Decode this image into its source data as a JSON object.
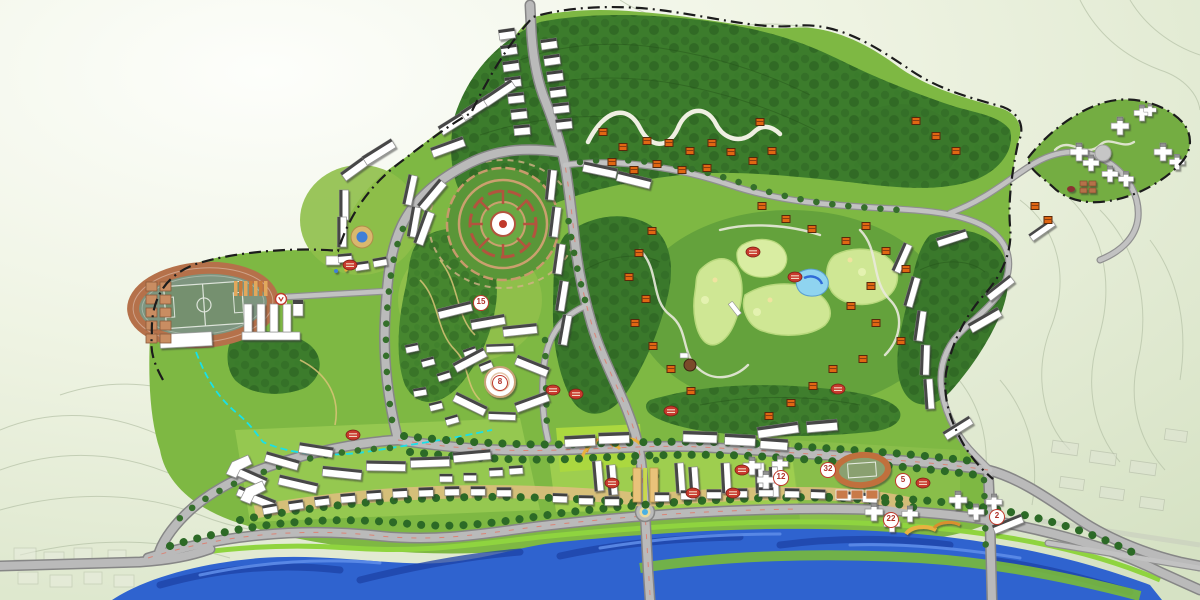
{
  "map": {
    "markers": [
      {
        "label": "15",
        "x": 481,
        "y": 303
      },
      {
        "label": "8",
        "x": 500,
        "y": 383
      },
      {
        "label": "12",
        "x": 781,
        "y": 478
      },
      {
        "label": "32",
        "x": 828,
        "y": 470
      },
      {
        "label": "5",
        "x": 903,
        "y": 481
      },
      {
        "label": "22",
        "x": 891,
        "y": 520
      },
      {
        "label": "2",
        "x": 997,
        "y": 517
      }
    ],
    "palette": {
      "river": "#2f63cf",
      "forest": "#2e6423",
      "site_green": "#7eb843",
      "fairway": "#cfe794",
      "road": "#bababa",
      "building": "#ffffff",
      "villa_roof": "#e06613",
      "marker_red": "#c0392b",
      "stream": "#19e0e8",
      "track": "#b5714a"
    }
  }
}
